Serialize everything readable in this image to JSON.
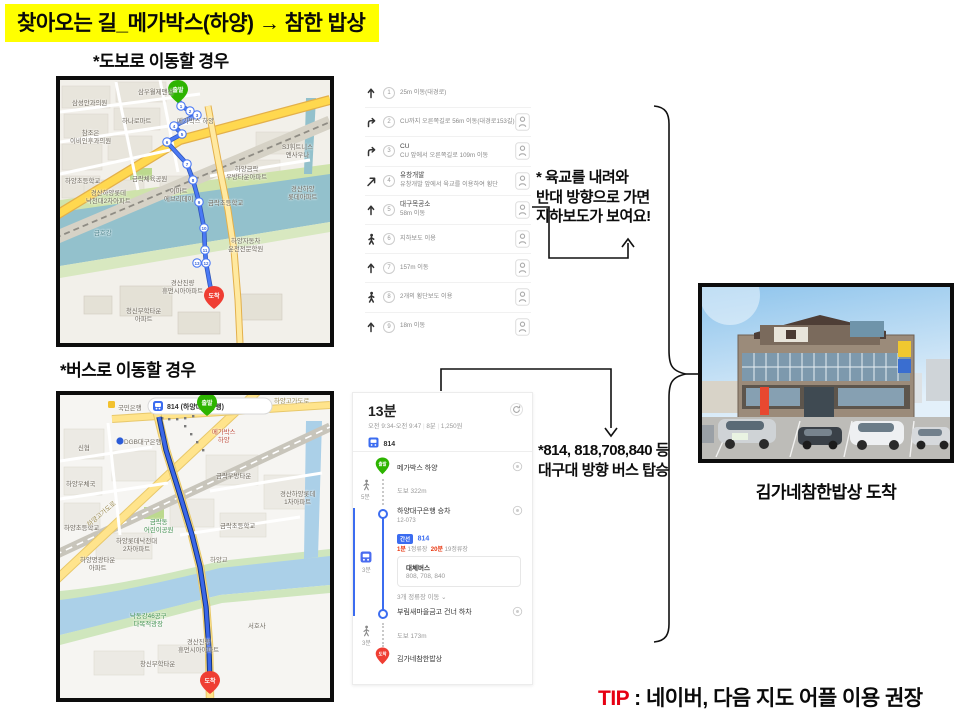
{
  "title": "찾아오는 길_메가박스(하양) → 참한 밥상",
  "sections": {
    "walk_label": "*도보로 이동할 경우",
    "bus_label": "*버스로 이동할 경우"
  },
  "walk_steps": [
    {
      "num": "1",
      "icon": "arrow-up",
      "text": "25m 이동(대경로)",
      "roadview": false
    },
    {
      "num": "2",
      "icon": "arrow-turn-right",
      "text": "CU까지 오른쪽길로 56m 이동(대경로153길)",
      "roadview": true
    },
    {
      "num": "3",
      "icon": "arrow-turn-right",
      "title": "CU",
      "text": "CU 앞에서 오른쪽길로 109m 이동",
      "roadview": true
    },
    {
      "num": "4",
      "icon": "arrow-diagonal",
      "title": "유창개발",
      "text": "유창개발 앞에서 육교를 이용하여 횡단",
      "roadview": true
    },
    {
      "num": "5",
      "icon": "arrow-up",
      "title": "대구목공소",
      "text": "58m 이동",
      "roadview": true
    },
    {
      "num": "6",
      "icon": "walker",
      "text": "지하보도 이용",
      "roadview": true
    },
    {
      "num": "7",
      "icon": "arrow-up",
      "text": "157m 이동",
      "roadview": true
    },
    {
      "num": "8",
      "icon": "walker",
      "text": "2개의 횡단보도 이용",
      "roadview": true
    },
    {
      "num": "9",
      "icon": "arrow-up",
      "text": "18m 이동",
      "roadview": true
    }
  ],
  "walk_note": {
    "lines": [
      "* 육교를 내려와",
      "반대 방향으로 가면",
      "지하보도가 보여요!"
    ]
  },
  "bus_note": {
    "lines": [
      "*814, 818,708,840 등",
      "대구대 방향 버스 탑승"
    ]
  },
  "bus_panel": {
    "duration": "13분",
    "time_range": "오전 9:34-오전 9:47",
    "walk_total": "8분",
    "fare": "1,250원",
    "bus_chip": "814",
    "start": {
      "marker": "출발",
      "name": "메가박스 하양"
    },
    "walk1": {
      "duration": "5분",
      "distance": "도보 322m"
    },
    "board": {
      "name": "하양대구은행 승차",
      "stop_id": "12-073",
      "badge": "간선",
      "bus": "814",
      "wait_time": "1분",
      "wait_stops": "1정류장",
      "interval_time": "20분",
      "interval_stops": "19정류장",
      "alt_title": "대체버스",
      "alt_buses": "808, 708, 840",
      "stops_note": "3개 정류장 이동 ⌄",
      "bus_duration": "3분"
    },
    "alight": {
      "name": "부림새마을금고 건너 하차"
    },
    "walk2": {
      "duration": "3분",
      "distance": "도보 173m"
    },
    "end": {
      "marker": "도착",
      "name": "김가네참한밥상"
    }
  },
  "photo_caption": "김가네참한밥상  도착",
  "tip": {
    "label": "TIP",
    "text": " : 네이버, 다음 지도 어플 이용 권장"
  },
  "walk_map": {
    "start_label": "출발",
    "end_label": "도착",
    "labels": [
      {
        "lines": [
          "삼성안과의원"
        ],
        "x": 12,
        "y": 20
      },
      {
        "lines": [
          "삼우월제맨션"
        ],
        "x": 78,
        "y": 9
      },
      {
        "lines": [
          "하나로마트"
        ],
        "x": 62,
        "y": 38
      },
      {
        "lines": [
          "참조은",
          "이비인후과의원"
        ],
        "x": 10,
        "y": 50
      },
      {
        "lines": [
          "하양초등학교"
        ],
        "x": 5,
        "y": 98
      },
      {
        "lines": [
          "메가박스 하양"
        ],
        "x": 117,
        "y": 38
      },
      {
        "lines": [
          "SJ휘트니스",
          "엔사우나"
        ],
        "x": 222,
        "y": 64
      },
      {
        "lines": [
          "하양금락",
          "우방타운아파트"
        ],
        "x": 166,
        "y": 86
      },
      {
        "lines": [
          "경산하양",
          "롯데아파트"
        ],
        "x": 228,
        "y": 106
      },
      {
        "lines": [
          "금락초등학교"
        ],
        "x": 148,
        "y": 120
      },
      {
        "lines": [
          "금락체육공원"
        ],
        "x": 72,
        "y": 96
      },
      {
        "lines": [
          "이마트",
          "에브리데이"
        ],
        "x": 104,
        "y": 108
      },
      {
        "lines": [
          "경산하양롯데",
          "낙천대2차아파트"
        ],
        "x": 26,
        "y": 110
      },
      {
        "lines": [
          "금호강"
        ],
        "x": 34,
        "y": 150,
        "c": "#53878f"
      },
      {
        "lines": [
          "하양자동차",
          "운전전문학원"
        ],
        "x": 168,
        "y": 158
      },
      {
        "lines": [
          "경산진량",
          "휴먼시아아파트"
        ],
        "x": 102,
        "y": 200
      },
      {
        "lines": [
          "청신무학타운",
          "아파트"
        ],
        "x": 66,
        "y": 228
      }
    ],
    "route_numbers": [
      {
        "n": "1",
        "x": 121,
        "y": 26
      },
      {
        "n": "2",
        "x": 130,
        "y": 31
      },
      {
        "n": "3",
        "x": 137,
        "y": 35
      },
      {
        "n": "4",
        "x": 114,
        "y": 46
      },
      {
        "n": "5",
        "x": 122,
        "y": 54
      },
      {
        "n": "6",
        "x": 107,
        "y": 62
      },
      {
        "n": "7",
        "x": 127,
        "y": 84
      },
      {
        "n": "8",
        "x": 133,
        "y": 100
      },
      {
        "n": "9",
        "x": 139,
        "y": 122
      },
      {
        "n": "10",
        "x": 144,
        "y": 148
      },
      {
        "n": "11",
        "x": 145,
        "y": 170
      },
      {
        "n": "13",
        "x": 137,
        "y": 183
      },
      {
        "n": "12",
        "x": 146,
        "y": 183
      }
    ]
  },
  "bus_map": {
    "start_label": "출발",
    "end_label": "도착",
    "stop_pill": "814 (하양대구은행)",
    "labels": [
      {
        "lines": [
          "신협"
        ],
        "x": 18,
        "y": 50
      },
      {
        "lines": [
          "하양우체국"
        ],
        "x": 6,
        "y": 86
      },
      {
        "lines": [
          "하양초등학교"
        ],
        "x": 4,
        "y": 130
      },
      {
        "lines": [
          "국민은행"
        ],
        "x": 58,
        "y": 10
      },
      {
        "lines": [
          "DGB대구은행"
        ],
        "x": 64,
        "y": 44
      },
      {
        "lines": [
          "메가박스",
          "하양"
        ],
        "x": 152,
        "y": 34,
        "c": "#c05040"
      },
      {
        "lines": [
          "하양고가도로"
        ],
        "x": 26,
        "y": 128,
        "c": "#9a8a50",
        "r": -40
      },
      {
        "lines": [
          "하양고가도로"
        ],
        "x": 214,
        "y": 3,
        "c": "#9a8a50"
      },
      {
        "lines": [
          "금락우방타운"
        ],
        "x": 156,
        "y": 78
      },
      {
        "lines": [
          "경산하양롯데",
          "1차아파트"
        ],
        "x": 220,
        "y": 96
      },
      {
        "lines": [
          "금락동",
          "어린이공원"
        ],
        "x": 84,
        "y": 124,
        "c": "#3f8f4f"
      },
      {
        "lines": [
          "금락초등학교"
        ],
        "x": 160,
        "y": 128
      },
      {
        "lines": [
          "하양롯데낙천대",
          "2차아파트"
        ],
        "x": 56,
        "y": 143
      },
      {
        "lines": [
          "하양명광타운",
          "아파트"
        ],
        "x": 20,
        "y": 162
      },
      {
        "lines": [
          "낙동강46공구",
          "다목적광장"
        ],
        "x": 70,
        "y": 218,
        "c": "#3f8f4f"
      },
      {
        "lines": [
          "서호사"
        ],
        "x": 188,
        "y": 228
      },
      {
        "lines": [
          "경산진량",
          "휴먼시아아파트"
        ],
        "x": 118,
        "y": 244
      },
      {
        "lines": [
          "창신무학타운"
        ],
        "x": 80,
        "y": 266
      },
      {
        "lines": [
          "하양교"
        ],
        "x": 150,
        "y": 162,
        "c": "#7a7468"
      }
    ]
  }
}
